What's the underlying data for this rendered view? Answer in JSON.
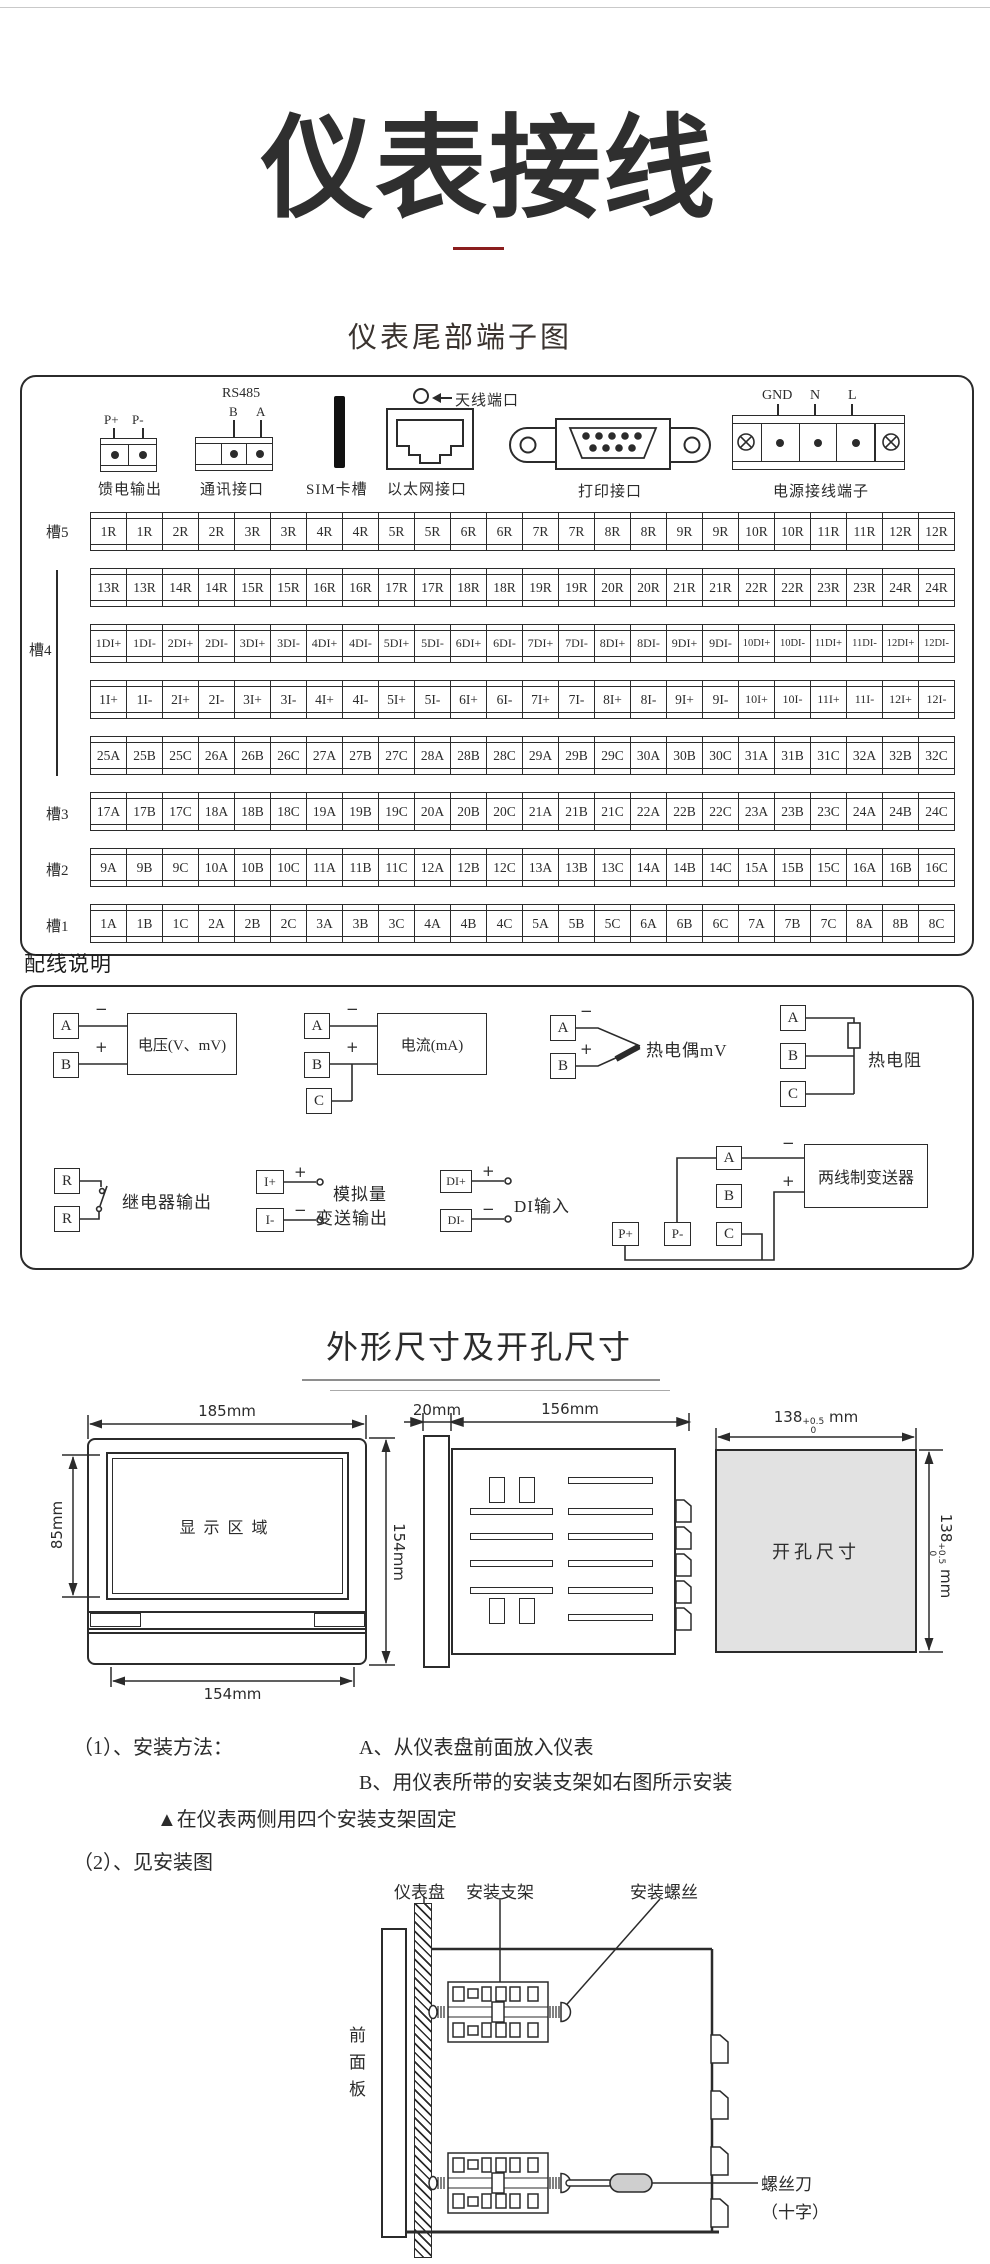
{
  "page": {
    "title": "仪表接线",
    "terminal_section_title": "仪表尾部端子图",
    "wiring_section_title": "配线说明",
    "dimension_section_title": "外形尺寸及开孔尺寸"
  },
  "colors": {
    "ink": "#2b2b2b",
    "accent_red": "#8b1e1e",
    "cutout_fill": "#e2e2e2"
  },
  "rear_panel": {
    "feed_output": {
      "label": "馈电输出",
      "pins": [
        "P+",
        "P-"
      ]
    },
    "comm_port": {
      "label": "通讯接口",
      "bus": "RS485",
      "pins": [
        "B",
        "A"
      ]
    },
    "sim_slot": {
      "label": "SIM卡槽"
    },
    "ethernet": {
      "label": "以太网接口"
    },
    "antenna": {
      "label": "天线端口"
    },
    "printer": {
      "label": "打印接口"
    },
    "power": {
      "label": "电源接线端子",
      "pins": [
        "GND",
        "N",
        "L"
      ]
    },
    "slots": [
      "槽5",
      "槽4",
      "槽3",
      "槽2",
      "槽1"
    ],
    "rows": [
      {
        "cells": [
          "1R",
          "1R",
          "2R",
          "2R",
          "3R",
          "3R",
          "4R",
          "4R",
          "5R",
          "5R",
          "6R",
          "6R",
          "7R",
          "7R",
          "8R",
          "8R",
          "9R",
          "9R",
          "10R",
          "10R",
          "11R",
          "11R",
          "12R",
          "12R"
        ]
      },
      {
        "cells": [
          "13R",
          "13R",
          "14R",
          "14R",
          "15R",
          "15R",
          "16R",
          "16R",
          "17R",
          "17R",
          "18R",
          "18R",
          "19R",
          "19R",
          "20R",
          "20R",
          "21R",
          "21R",
          "22R",
          "22R",
          "23R",
          "23R",
          "24R",
          "24R"
        ]
      },
      {
        "cells": [
          "1DI+",
          "1DI-",
          "2DI+",
          "2DI-",
          "3DI+",
          "3DI-",
          "4DI+",
          "4DI-",
          "5DI+",
          "5DI-",
          "6DI+",
          "6DI-",
          "7DI+",
          "7DI-",
          "8DI+",
          "8DI-",
          "9DI+",
          "9DI-",
          "10DI+",
          "10DI-",
          "11DI+",
          "11DI-",
          "12DI+",
          "12DI-"
        ]
      },
      {
        "cells": [
          "1I+",
          "1I-",
          "2I+",
          "2I-",
          "3I+",
          "3I-",
          "4I+",
          "4I-",
          "5I+",
          "5I-",
          "6I+",
          "6I-",
          "7I+",
          "7I-",
          "8I+",
          "8I-",
          "9I+",
          "9I-",
          "10I+",
          "10I-",
          "11I+",
          "11I-",
          "12I+",
          "12I-"
        ]
      },
      {
        "cells": [
          "25A",
          "25B",
          "25C",
          "26A",
          "26B",
          "26C",
          "27A",
          "27B",
          "27C",
          "28A",
          "28B",
          "28C",
          "29A",
          "29B",
          "29C",
          "30A",
          "30B",
          "30C",
          "31A",
          "31B",
          "31C",
          "32A",
          "32B",
          "32C"
        ]
      },
      {
        "cells": [
          "17A",
          "17B",
          "17C",
          "18A",
          "18B",
          "18C",
          "19A",
          "19B",
          "19C",
          "20A",
          "20B",
          "20C",
          "21A",
          "21B",
          "21C",
          "22A",
          "22B",
          "22C",
          "23A",
          "23B",
          "23C",
          "24A",
          "24B",
          "24C"
        ]
      },
      {
        "cells": [
          "9A",
          "9B",
          "9C",
          "10A",
          "10B",
          "10C",
          "11A",
          "11B",
          "11C",
          "12A",
          "12B",
          "12C",
          "13A",
          "13B",
          "13C",
          "14A",
          "14B",
          "14C",
          "15A",
          "15B",
          "15C",
          "16A",
          "16B",
          "16C"
        ]
      },
      {
        "cells": [
          "1A",
          "1B",
          "1C",
          "2A",
          "2B",
          "2C",
          "3A",
          "3B",
          "3C",
          "4A",
          "4B",
          "4C",
          "5A",
          "5B",
          "5C",
          "6A",
          "6B",
          "6C",
          "7A",
          "7B",
          "7C",
          "8A",
          "8B",
          "8C"
        ]
      }
    ]
  },
  "wiring": {
    "voltage": {
      "terminals": [
        "A",
        "B"
      ],
      "signs": [
        "−",
        "+"
      ],
      "label": "电压(V、mV)"
    },
    "current": {
      "terminals": [
        "A",
        "B",
        "C"
      ],
      "signs": [
        "−",
        "+"
      ],
      "label": "电流(mA)"
    },
    "thermocouple": {
      "terminals": [
        "A",
        "B"
      ],
      "signs": [
        "−",
        "+"
      ],
      "label": "热电偶mV"
    },
    "rtd": {
      "terminals": [
        "A",
        "B",
        "C"
      ],
      "label": "热电阻"
    },
    "relay": {
      "terminals": [
        "R",
        "R"
      ],
      "label": "继电器输出"
    },
    "analog_out": {
      "terminals": [
        "I+",
        "I-"
      ],
      "signs": [
        "+",
        "−"
      ],
      "label_line1": "模拟量",
      "label_line2": "变送输出"
    },
    "di": {
      "terminals": [
        "DI+",
        "DI-"
      ],
      "signs": [
        "+",
        "−"
      ],
      "label": "DI输入"
    },
    "transmitter": {
      "terminals": [
        "A",
        "B",
        "C"
      ],
      "power_pins": [
        "P+",
        "P-"
      ],
      "signs": [
        "−",
        "+"
      ],
      "label": "两线制变送器"
    }
  },
  "dimensions": {
    "front_view": {
      "width_top": "185mm",
      "screen_height": "85mm",
      "height_right": "154mm",
      "width_bottom": "154mm",
      "screen_label": "显示区域"
    },
    "side_view": {
      "bezel_depth": "20mm",
      "body_depth": "156mm"
    },
    "cutout": {
      "label": "开孔尺寸",
      "dim_value": "138",
      "tol_upper": "+0.5",
      "tol_lower": "0",
      "unit": "mm"
    }
  },
  "install": {
    "line1_label": "（1）、安装方法：",
    "line1_text": "A、从仪表盘前面放入仪表",
    "line2_text": "B、用仪表所带的安装支架如右图所示安装",
    "line3_text": "▲在仪表两侧用四个安装支架固定",
    "line4_text": "（2）、见安装图",
    "diagram": {
      "panel_label": "仪表盘",
      "bracket_label": "安装支架",
      "screw_label": "安装螺丝",
      "front_panel_label": "前面板",
      "screwdriver_label": "螺丝刀",
      "screwdriver_type": "（十字）"
    }
  }
}
